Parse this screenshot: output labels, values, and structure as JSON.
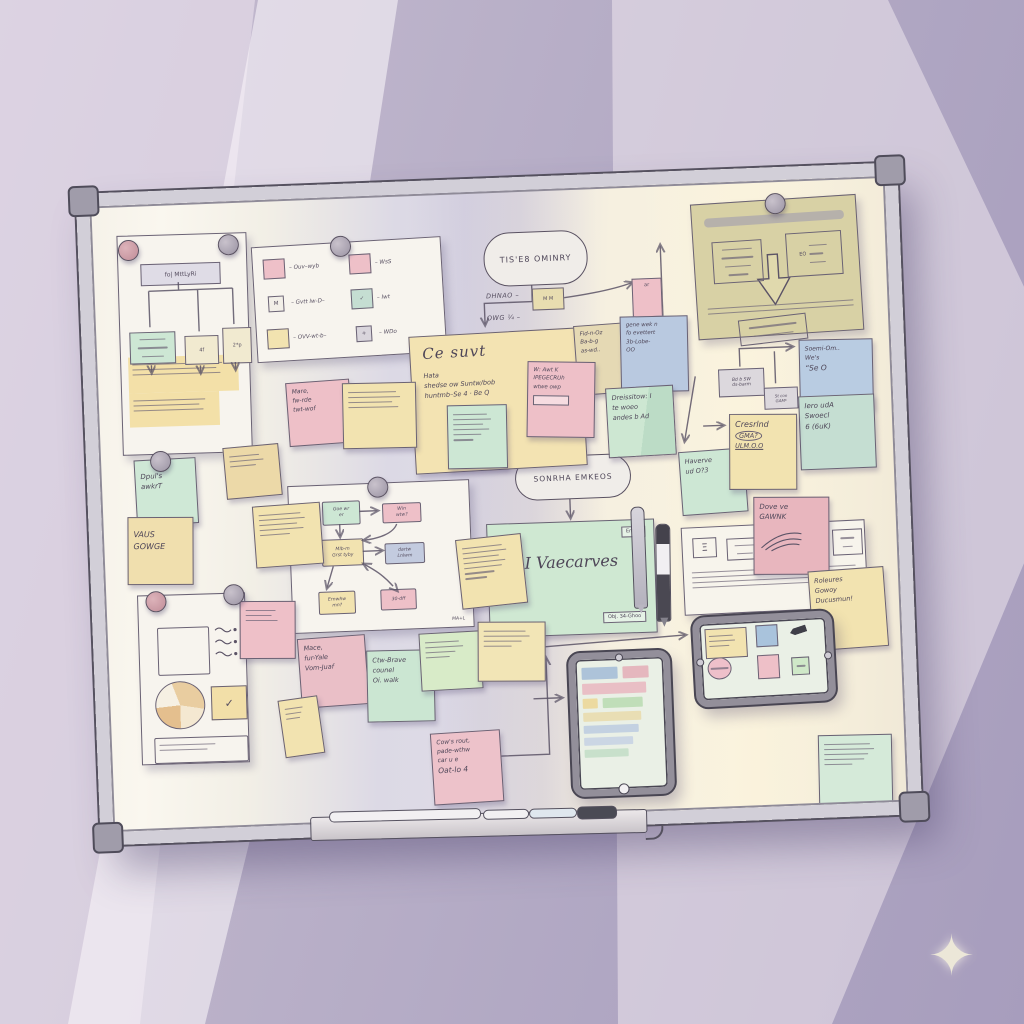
{
  "colors": {
    "wall": "#b2a9c4",
    "board_surface": "#f4efe4",
    "frame": "#d2cfd8",
    "note_yellow": "#f2e3b0",
    "note_pink": "#eec0c8",
    "note_mint": "#cde7d4",
    "note_blue": "#b9c9e0",
    "note_teal": "#c5ded2",
    "note_tan": "#e5d9b4",
    "poster_khaki": "#d8d1a5",
    "ink": "#564e60",
    "pin_pink": "#c08d98",
    "pin_gray": "#9a93a3"
  },
  "icons": {
    "sparkle": "✦"
  },
  "board": {
    "paper_flowchart": {
      "header": "fo| MttLyRi",
      "box_mid": "4f",
      "box_right": "2*p"
    },
    "legend": {
      "items": [
        {
          "label": "– Ouv–wyb",
          "swatch_text": ""
        },
        {
          "label": "– WsS",
          "swatch_text": ""
        },
        {
          "label": "– Gvtt lw-D–",
          "swatch_text": "M"
        },
        {
          "label": "– Iwt",
          "swatch_text": "✓"
        },
        {
          "label": "– OVV-wt-b–",
          "swatch_text": ""
        },
        {
          "label": "– WDo",
          "swatch_text": "+"
        }
      ]
    },
    "cloud_top": "TIS'E8  OMINRY",
    "branch": {
      "label_top": "DHNAO –",
      "box": "M M",
      "label_bottom": "OWG ¼ –",
      "pink_box": "ar"
    },
    "note_ce_suvt": {
      "title": "Ce suvt",
      "lines": [
        "Hata",
        "shedse ow  Suntw/bob",
        "huntmb–Se   4  ·  Be  Q"
      ]
    },
    "note_ipeg": {
      "lines": [
        "W: Awt K",
        "IPEGECRUh",
        "wtwe owp"
      ]
    },
    "note_fid": {
      "lines": [
        "Fid-n-Oz",
        "Ba-b-g",
        "as-wd.."
      ]
    },
    "note_wek": {
      "lines": [
        "gene wek n",
        "fo evettert",
        "3b-Lobe-",
        "OO"
      ]
    },
    "note_dreis": {
      "lines": [
        "Dreissitow: I",
        "te woeo",
        "andes b Ad"
      ]
    },
    "box_bd": {
      "lines": [
        "Bd b SW",
        "ds-barm"
      ]
    },
    "box_st": {
      "lines": [
        "St con",
        "GAM*"
      ]
    },
    "note_soemi": {
      "lines": [
        "Soemi-Om..",
        "We's",
        "“Se O"
      ]
    },
    "note_iero": {
      "lines": [
        "Iero udA",
        "Swoecl",
        "6 (6uK)"
      ]
    },
    "note_cres": {
      "lines": [
        "Cresrlnd",
        "GMA?",
        "ULM.O.O"
      ]
    },
    "note_hav": {
      "lines": [
        "Haverve",
        "ud O?3"
      ]
    },
    "cloud_mid": "SONRHA EMKEOS",
    "note_vaecarves": {
      "tag": "Em. b",
      "title": "I Vaecarves",
      "chip": "Obj. 34-Ghoo"
    },
    "flow_card": {
      "box_teal": [
        "Goe wr",
        "er"
      ],
      "box_pink": [
        "Win",
        "wtw?"
      ],
      "box_yellow": [
        "Mlb-m",
        "Grst tyby"
      ],
      "box_blue": [
        "dartw",
        "Lnlwm"
      ],
      "box_yellow2": [
        "Ernwhw",
        "mn?"
      ],
      "box_pink2": "30-dff",
      "corner_note": "MA+L"
    },
    "note_dpul": {
      "lines": [
        "Dpul's",
        "awkrT"
      ]
    },
    "note_vaus": {
      "lines": [
        "VAUS",
        "GOWGE"
      ]
    },
    "note_mare": {
      "lines": [
        "Mare,",
        "fw-rde",
        "twt-wof"
      ]
    },
    "note_mace": {
      "lines": [
        "Mace,",
        "fur-Yale",
        "Vom-Juaf"
      ]
    },
    "note_ctw": {
      "lines": [
        "Ctw-Brave",
        "counel",
        "Oi. walk"
      ]
    },
    "note_cows": {
      "lines": [
        "Cow's rout,",
        "pade-wthw",
        "car u e",
        "Oat-lo 4"
      ]
    },
    "note_dove": {
      "lines": [
        "Dove ve",
        "GAWNK"
      ]
    },
    "note_role": {
      "lines": [
        "Roleures",
        "Gowoy",
        "Ducusmun!"
      ]
    },
    "poster": {
      "box_label": "EO"
    },
    "doc_card": {
      "menu_icon": "Ξ"
    }
  }
}
